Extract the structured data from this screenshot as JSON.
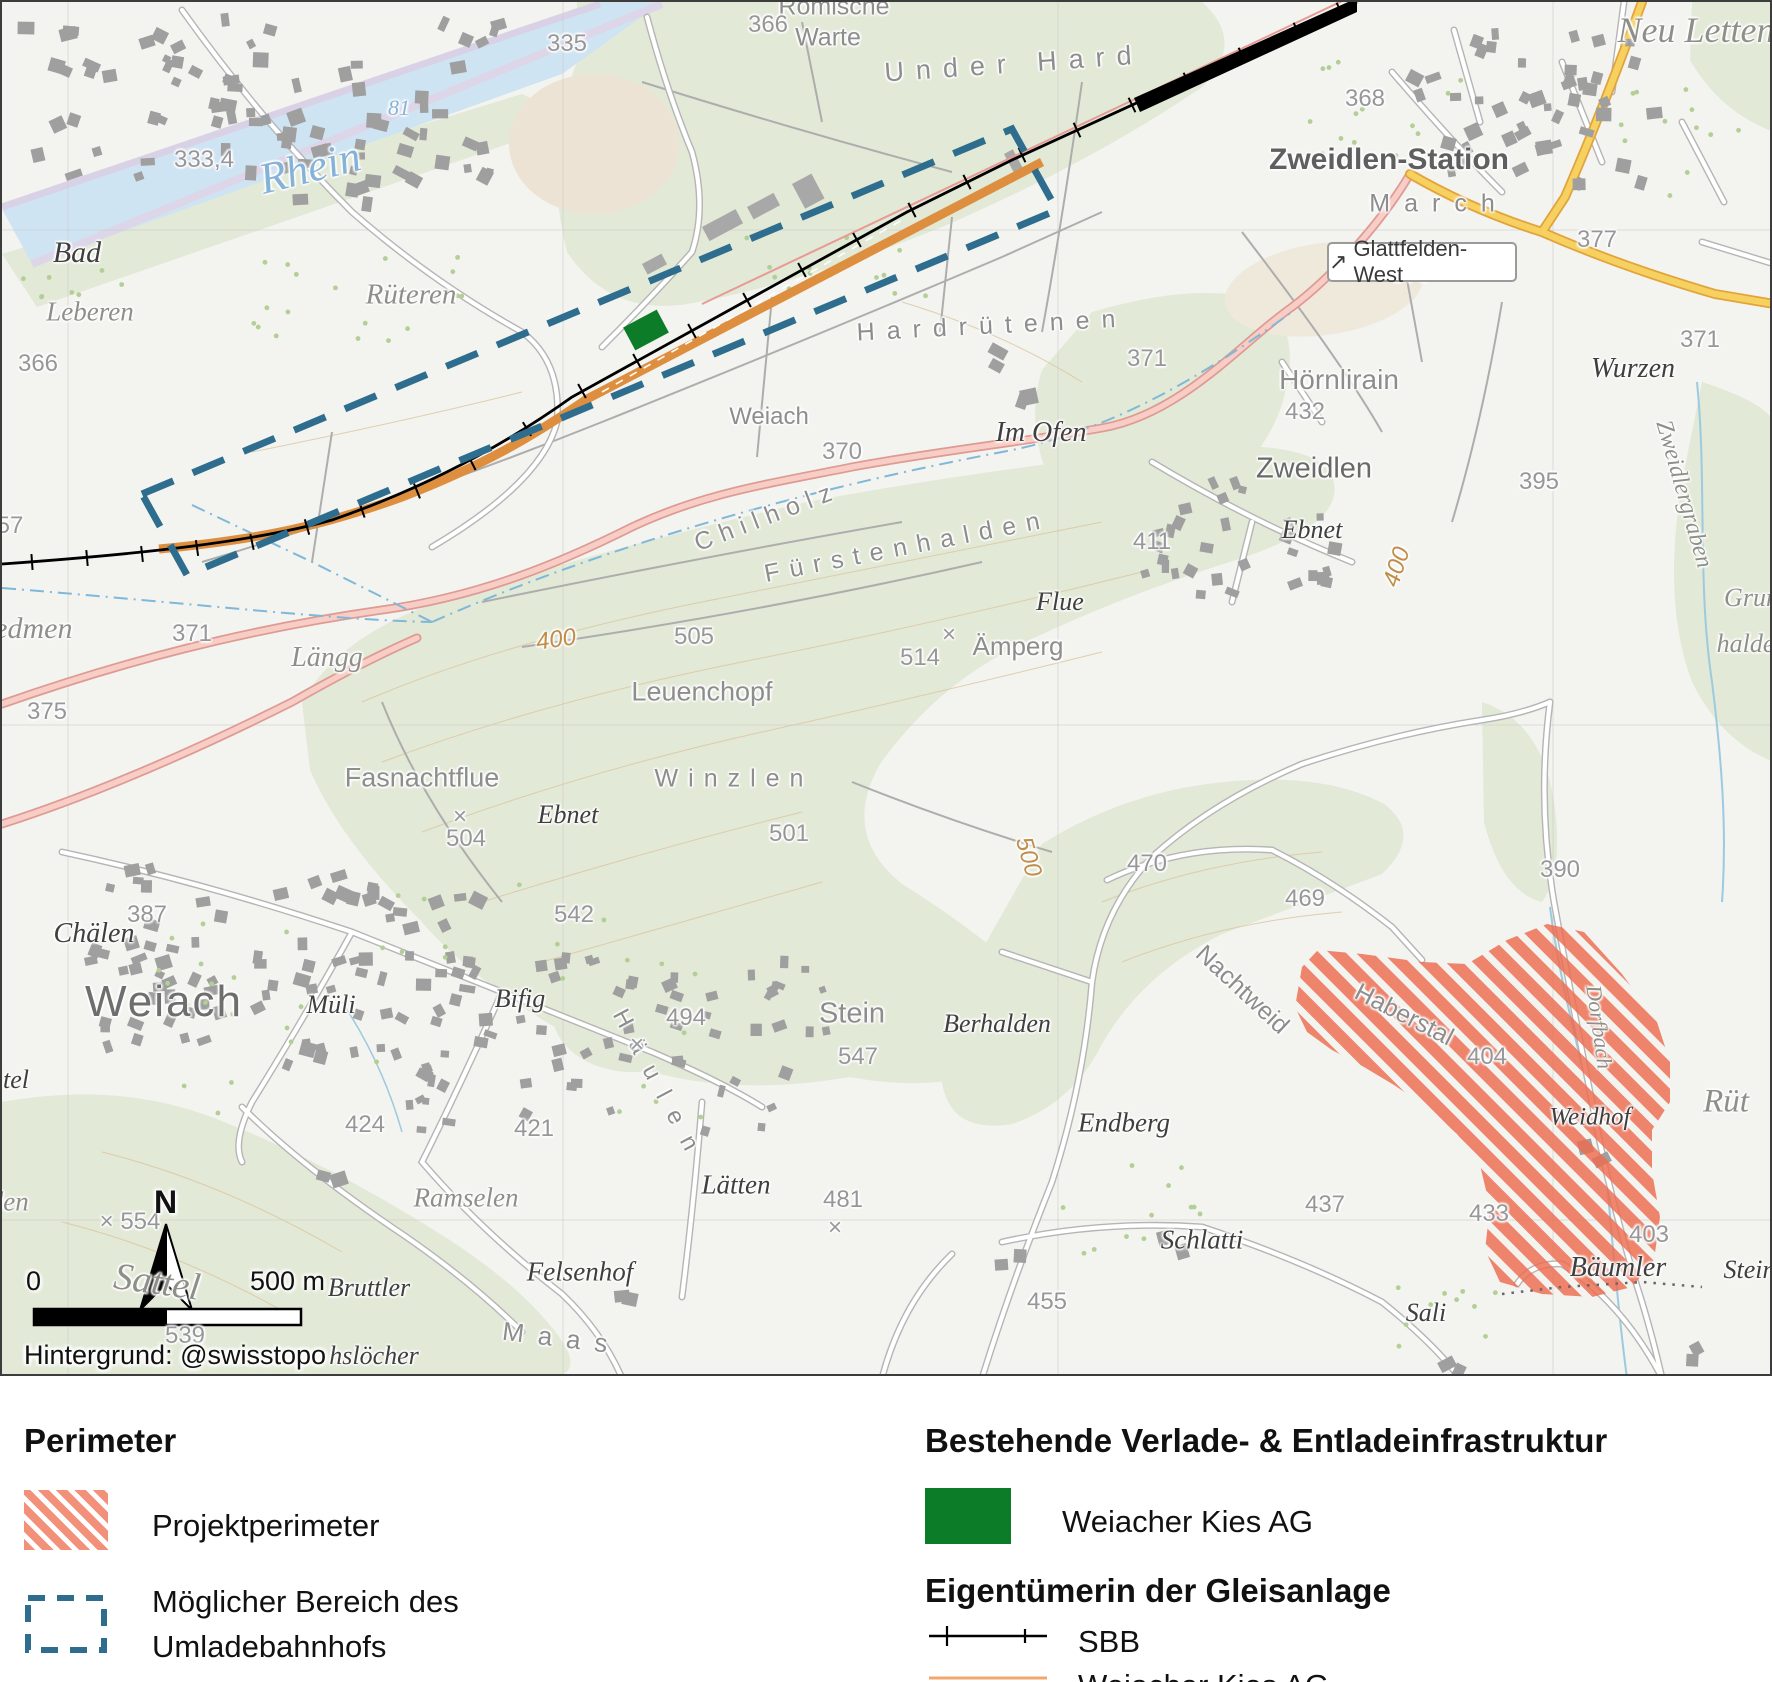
{
  "map": {
    "attribution": "Hintergrund: @swisstopo",
    "scale_bar": {
      "zero": "0",
      "distance": "500 m"
    },
    "north_label": "N",
    "road_sign": {
      "arrow": "↗",
      "text": "Glattfelden-West"
    },
    "colors": {
      "project_perimeter_hatch": "#ed6b4e",
      "umladebahnhof_dash": "#2e6d8e",
      "weiacher_kies_area": "#0c7c28",
      "sbb_track": "#000000",
      "weiacher_kies_track": "#dd8f3f"
    },
    "labels": [
      {
        "t": "Römische",
        "c": "ar",
        "x": 832,
        "y": 5,
        "fs": 25
      },
      {
        "t": "Warte",
        "c": "ar",
        "x": 826,
        "y": 36,
        "fs": 25
      },
      {
        "t": "366",
        "c": "el",
        "x": 766,
        "y": 23
      },
      {
        "t": "Under Hard",
        "c": "arsp",
        "x": 1012,
        "y": 62,
        "r": -4,
        "ls": 12,
        "fs": 27
      },
      {
        "t": "Neu Letten",
        "c": "fg",
        "x": 1694,
        "y": 28,
        "fs": 36
      },
      {
        "t": "368",
        "c": "el",
        "x": 1363,
        "y": 97
      },
      {
        "t": "Zweidlen-Station",
        "c": "st",
        "x": 1387,
        "y": 158
      },
      {
        "t": "March",
        "c": "arsp",
        "x": 1437,
        "y": 202,
        "ls": 14,
        "fs": 25
      },
      {
        "t": "377",
        "c": "el",
        "x": 1595,
        "y": 238
      },
      {
        "t": "335",
        "c": "el",
        "x": 565,
        "y": 42
      },
      {
        "t": "Rhein",
        "c": "wa",
        "x": 308,
        "y": 166,
        "r": -14,
        "fs": 44
      },
      {
        "t": "81",
        "c": "wa",
        "x": 397,
        "y": 106,
        "fs": 22
      },
      {
        "t": "333,4",
        "c": "el",
        "x": 202,
        "y": 158
      },
      {
        "t": "Bad",
        "c": "fd",
        "x": 75,
        "y": 251,
        "fs": 30
      },
      {
        "t": "Rüteren",
        "c": "fg",
        "x": 409,
        "y": 293,
        "fs": 29
      },
      {
        "t": "Leberen",
        "c": "fg",
        "x": 88,
        "y": 310
      },
      {
        "t": "57",
        "c": "el",
        "x": 8,
        "y": 524
      },
      {
        "t": "366",
        "c": "el",
        "x": 36,
        "y": 362
      },
      {
        "t": "Hardrütenen",
        "c": "arsp",
        "x": 990,
        "y": 324,
        "r": -3,
        "ls": 12
      },
      {
        "t": "Weiach",
        "c": "ar",
        "x": 767,
        "y": 415,
        "fs": 24
      },
      {
        "t": "Im Ofen",
        "c": "fd",
        "x": 1039,
        "y": 431,
        "fs": 28
      },
      {
        "t": "370",
        "c": "el",
        "x": 840,
        "y": 450
      },
      {
        "t": "373",
        "c": "el",
        "x": 1409,
        "y": 273
      },
      {
        "t": "371",
        "c": "el",
        "x": 1145,
        "y": 357
      },
      {
        "t": "Hörnlirain",
        "c": "ar",
        "x": 1337,
        "y": 378,
        "fs": 28
      },
      {
        "t": "432",
        "c": "el",
        "x": 1303,
        "y": 410
      },
      {
        "t": "Zweidlen",
        "c": "vl",
        "x": 1312,
        "y": 467
      },
      {
        "t": "Wurzen",
        "c": "fd",
        "x": 1631,
        "y": 367,
        "fs": 28
      },
      {
        "t": "371",
        "c": "el",
        "x": 1698,
        "y": 338
      },
      {
        "t": "395",
        "c": "el",
        "x": 1537,
        "y": 480
      },
      {
        "t": "Ebnet",
        "c": "fd",
        "x": 1310,
        "y": 528
      },
      {
        "t": "411",
        "c": "el",
        "x": 1150,
        "y": 540
      },
      {
        "t": "Zweidlergraben",
        "c": "fg",
        "x": 1682,
        "y": 492,
        "r": 74,
        "fs": 24
      },
      {
        "t": "Grund",
        "c": "fg",
        "x": 1756,
        "y": 596,
        "fs": 26
      },
      {
        "t": "halden",
        "c": "fg",
        "x": 1750,
        "y": 642,
        "fs": 26
      },
      {
        "t": "Chilholz",
        "c": "arsp",
        "x": 765,
        "y": 515,
        "r": -21,
        "ls": 8
      },
      {
        "t": "Fürstenhalden",
        "c": "arsp",
        "x": 905,
        "y": 545,
        "r": -11,
        "ls": 10
      },
      {
        "t": "Flue",
        "c": "fd",
        "x": 1058,
        "y": 600
      },
      {
        "t": "Ämperg",
        "c": "ar",
        "x": 1016,
        "y": 644
      },
      {
        "t": "×",
        "c": "el",
        "x": 947,
        "y": 633
      },
      {
        "t": "514",
        "c": "el",
        "x": 918,
        "y": 656
      },
      {
        "t": "505",
        "c": "el",
        "x": 692,
        "y": 635
      },
      {
        "t": "Leuenchopf",
        "c": "ar",
        "x": 700,
        "y": 690,
        "fs": 27
      },
      {
        "t": "400",
        "c": "elc",
        "x": 554,
        "y": 638,
        "r": -8
      },
      {
        "t": "400",
        "c": "elc",
        "x": 1395,
        "y": 565,
        "r": -72
      },
      {
        "t": "Riedmen",
        "c": "fg",
        "x": 18,
        "y": 627,
        "fs": 30
      },
      {
        "t": "371",
        "c": "el",
        "x": 190,
        "y": 632
      },
      {
        "t": "375",
        "c": "el",
        "x": 45,
        "y": 710
      },
      {
        "t": "Längg",
        "c": "fg",
        "x": 325,
        "y": 656,
        "fs": 28
      },
      {
        "t": "Fasnachtflue",
        "c": "ar",
        "x": 420,
        "y": 776,
        "fs": 27
      },
      {
        "t": "Ebnet",
        "c": "fd",
        "x": 566,
        "y": 813
      },
      {
        "t": "×",
        "c": "el",
        "x": 458,
        "y": 815
      },
      {
        "t": "504",
        "c": "el",
        "x": 464,
        "y": 837
      },
      {
        "t": "Winzlen",
        "c": "arsp",
        "x": 732,
        "y": 777,
        "ls": 10
      },
      {
        "t": "501",
        "c": "el",
        "x": 787,
        "y": 832
      },
      {
        "t": "542",
        "c": "el",
        "x": 572,
        "y": 913
      },
      {
        "t": "500",
        "c": "elc",
        "x": 1026,
        "y": 855,
        "r": 74
      },
      {
        "t": "Chälen",
        "c": "fd",
        "x": 92,
        "y": 932,
        "fs": 28
      },
      {
        "t": "387",
        "c": "el",
        "x": 145,
        "y": 913
      },
      {
        "t": "Weiach",
        "c": "tn",
        "x": 162,
        "y": 1000
      },
      {
        "t": "Müli",
        "c": "fd",
        "x": 329,
        "y": 1003
      },
      {
        "t": "Bifig",
        "c": "fd",
        "x": 518,
        "y": 997
      },
      {
        "t": "Häulen",
        "c": "arsp",
        "x": 657,
        "y": 1085,
        "r": 62,
        "ls": 16,
        "fs": 24
      },
      {
        "t": "Stein",
        "c": "ar",
        "x": 850,
        "y": 1012,
        "fs": 29
      },
      {
        "t": "×",
        "c": "el",
        "x": 635,
        "y": 1043
      },
      {
        "t": "494",
        "c": "el",
        "x": 684,
        "y": 1016
      },
      {
        "t": "547",
        "c": "el",
        "x": 856,
        "y": 1055
      },
      {
        "t": "Berhalden",
        "c": "fd",
        "x": 995,
        "y": 1022
      },
      {
        "t": "Nachtweid",
        "c": "ar",
        "x": 1240,
        "y": 988,
        "r": 43,
        "fs": 25
      },
      {
        "t": "Haberstal",
        "c": "ar",
        "x": 1402,
        "y": 1013,
        "r": 27,
        "fs": 25
      },
      {
        "t": "404",
        "c": "el",
        "x": 1485,
        "y": 1055
      },
      {
        "t": "Weidhof",
        "c": "fd",
        "x": 1588,
        "y": 1115,
        "fs": 25
      },
      {
        "t": "Dorfbach",
        "c": "fg",
        "x": 1597,
        "y": 1025,
        "r": 82,
        "fs": 22
      },
      {
        "t": "469",
        "c": "el",
        "x": 1303,
        "y": 897
      },
      {
        "t": "470",
        "c": "el",
        "x": 1145,
        "y": 862
      },
      {
        "t": "390",
        "c": "el",
        "x": 1558,
        "y": 868
      },
      {
        "t": "Rüt",
        "c": "fg",
        "x": 1724,
        "y": 1100,
        "fs": 33
      },
      {
        "t": "Endberg",
        "c": "fd",
        "x": 1122,
        "y": 1121,
        "fs": 27
      },
      {
        "t": "424",
        "c": "el",
        "x": 363,
        "y": 1123
      },
      {
        "t": "421",
        "c": "el",
        "x": 532,
        "y": 1127
      },
      {
        "t": "Ramselen",
        "c": "fg",
        "x": 464,
        "y": 1196
      },
      {
        "t": "Lätten",
        "c": "fd",
        "x": 734,
        "y": 1183,
        "fs": 27
      },
      {
        "t": "481",
        "c": "el",
        "x": 841,
        "y": 1198
      },
      {
        "t": "×",
        "c": "el",
        "x": 833,
        "y": 1226
      },
      {
        "t": "Felsenhof",
        "c": "fd",
        "x": 578,
        "y": 1270,
        "fs": 27
      },
      {
        "t": "Schlatti",
        "c": "fd",
        "x": 1200,
        "y": 1238,
        "fs": 27
      },
      {
        "t": "437",
        "c": "el",
        "x": 1323,
        "y": 1203
      },
      {
        "t": "433",
        "c": "el",
        "x": 1487,
        "y": 1212
      },
      {
        "t": "403",
        "c": "el",
        "x": 1647,
        "y": 1233
      },
      {
        "t": "455",
        "c": "el",
        "x": 1045,
        "y": 1300
      },
      {
        "t": "Sali",
        "c": "fd",
        "x": 1424,
        "y": 1311
      },
      {
        "t": "Bäumler",
        "c": "fd",
        "x": 1616,
        "y": 1266,
        "fs": 28
      },
      {
        "t": "Steina",
        "c": "fd",
        "x": 1754,
        "y": 1268
      },
      {
        "t": "tel",
        "c": "fd",
        "x": 14,
        "y": 1078
      },
      {
        "t": "halden",
        "c": "fg",
        "x": -10,
        "y": 1200
      },
      {
        "t": "× 554",
        "c": "el",
        "x": 128,
        "y": 1220
      },
      {
        "t": "Sattel",
        "c": "fg",
        "x": 155,
        "y": 1280,
        "r": 8,
        "fs": 38
      },
      {
        "t": "539",
        "c": "el",
        "x": 183,
        "y": 1334
      },
      {
        "t": "Bruttler",
        "c": "fd",
        "x": 367,
        "y": 1286
      },
      {
        "t": "hslöcher",
        "c": "fd",
        "x": 372,
        "y": 1354
      },
      {
        "t": "Maas",
        "c": "arsp",
        "x": 560,
        "y": 1336,
        "r": 7,
        "ls": 14,
        "fs": 26
      }
    ]
  },
  "legend": {
    "left": {
      "heading": "Perimeter",
      "item1_label": "Projektperimeter",
      "item2_line1": "Möglicher Bereich des",
      "item2_line2": "Umladebahnhofs"
    },
    "right": {
      "heading1": "Bestehende Verlade- & Entladeinfrastruktur",
      "item1_label": "Weiacher Kies AG",
      "heading2": "Eigentümerin der Gleisanlage",
      "item2_label": "SBB",
      "item3_label": "Weiacher Kies AG"
    }
  }
}
